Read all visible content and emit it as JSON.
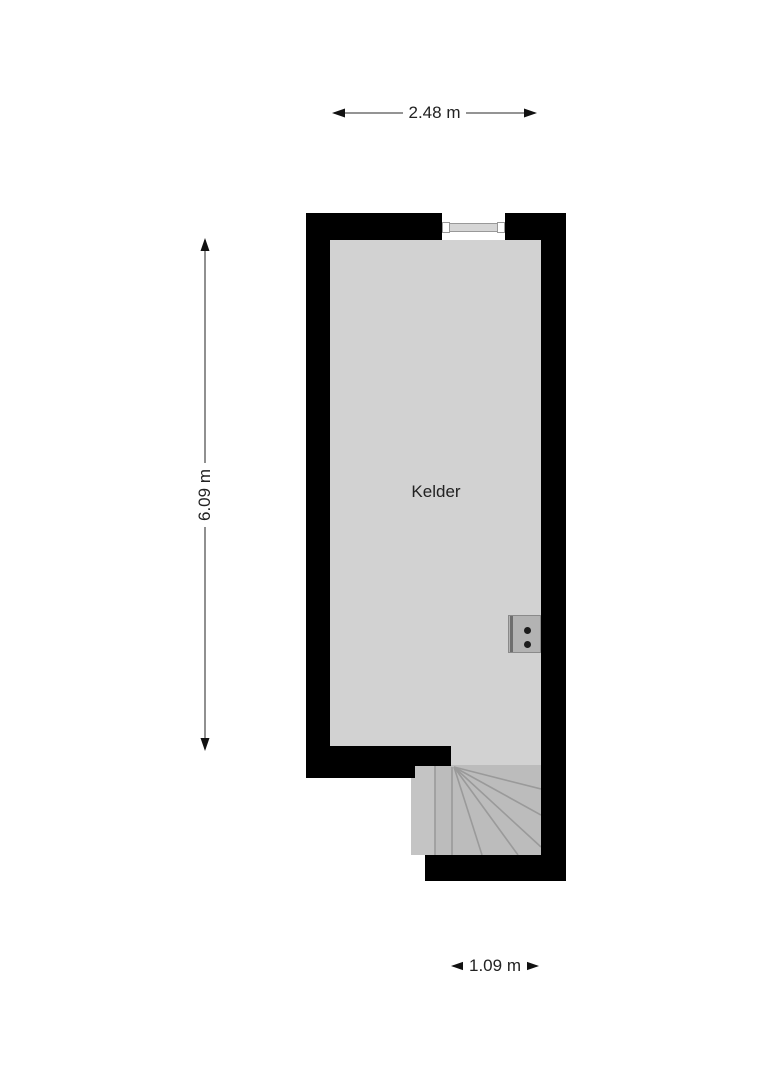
{
  "plan": {
    "room_label": "Kelder",
    "dimensions": {
      "width": {
        "label": "2.48 m"
      },
      "height": {
        "label": "6.09 m"
      },
      "stair_width": {
        "label": "1.09 m"
      }
    },
    "colors": {
      "wall": "#000000",
      "room_fill": "#d2d2d2",
      "stair_fill": "#bcbcbc",
      "stair_first_tread": "#c4c4c4",
      "stair_line": "#9a9a9a",
      "dim_line": "#555555",
      "dim_arrow": "#111111",
      "text": "#222222",
      "window_frame": "#d6d6d6",
      "window_border": "#999999",
      "fixture_fill": "#b3b3b3",
      "fixture_border": "#8a8a8a",
      "fixture_stripe": "#6e6e6e",
      "fixture_dot": "#1c1c1c"
    }
  }
}
